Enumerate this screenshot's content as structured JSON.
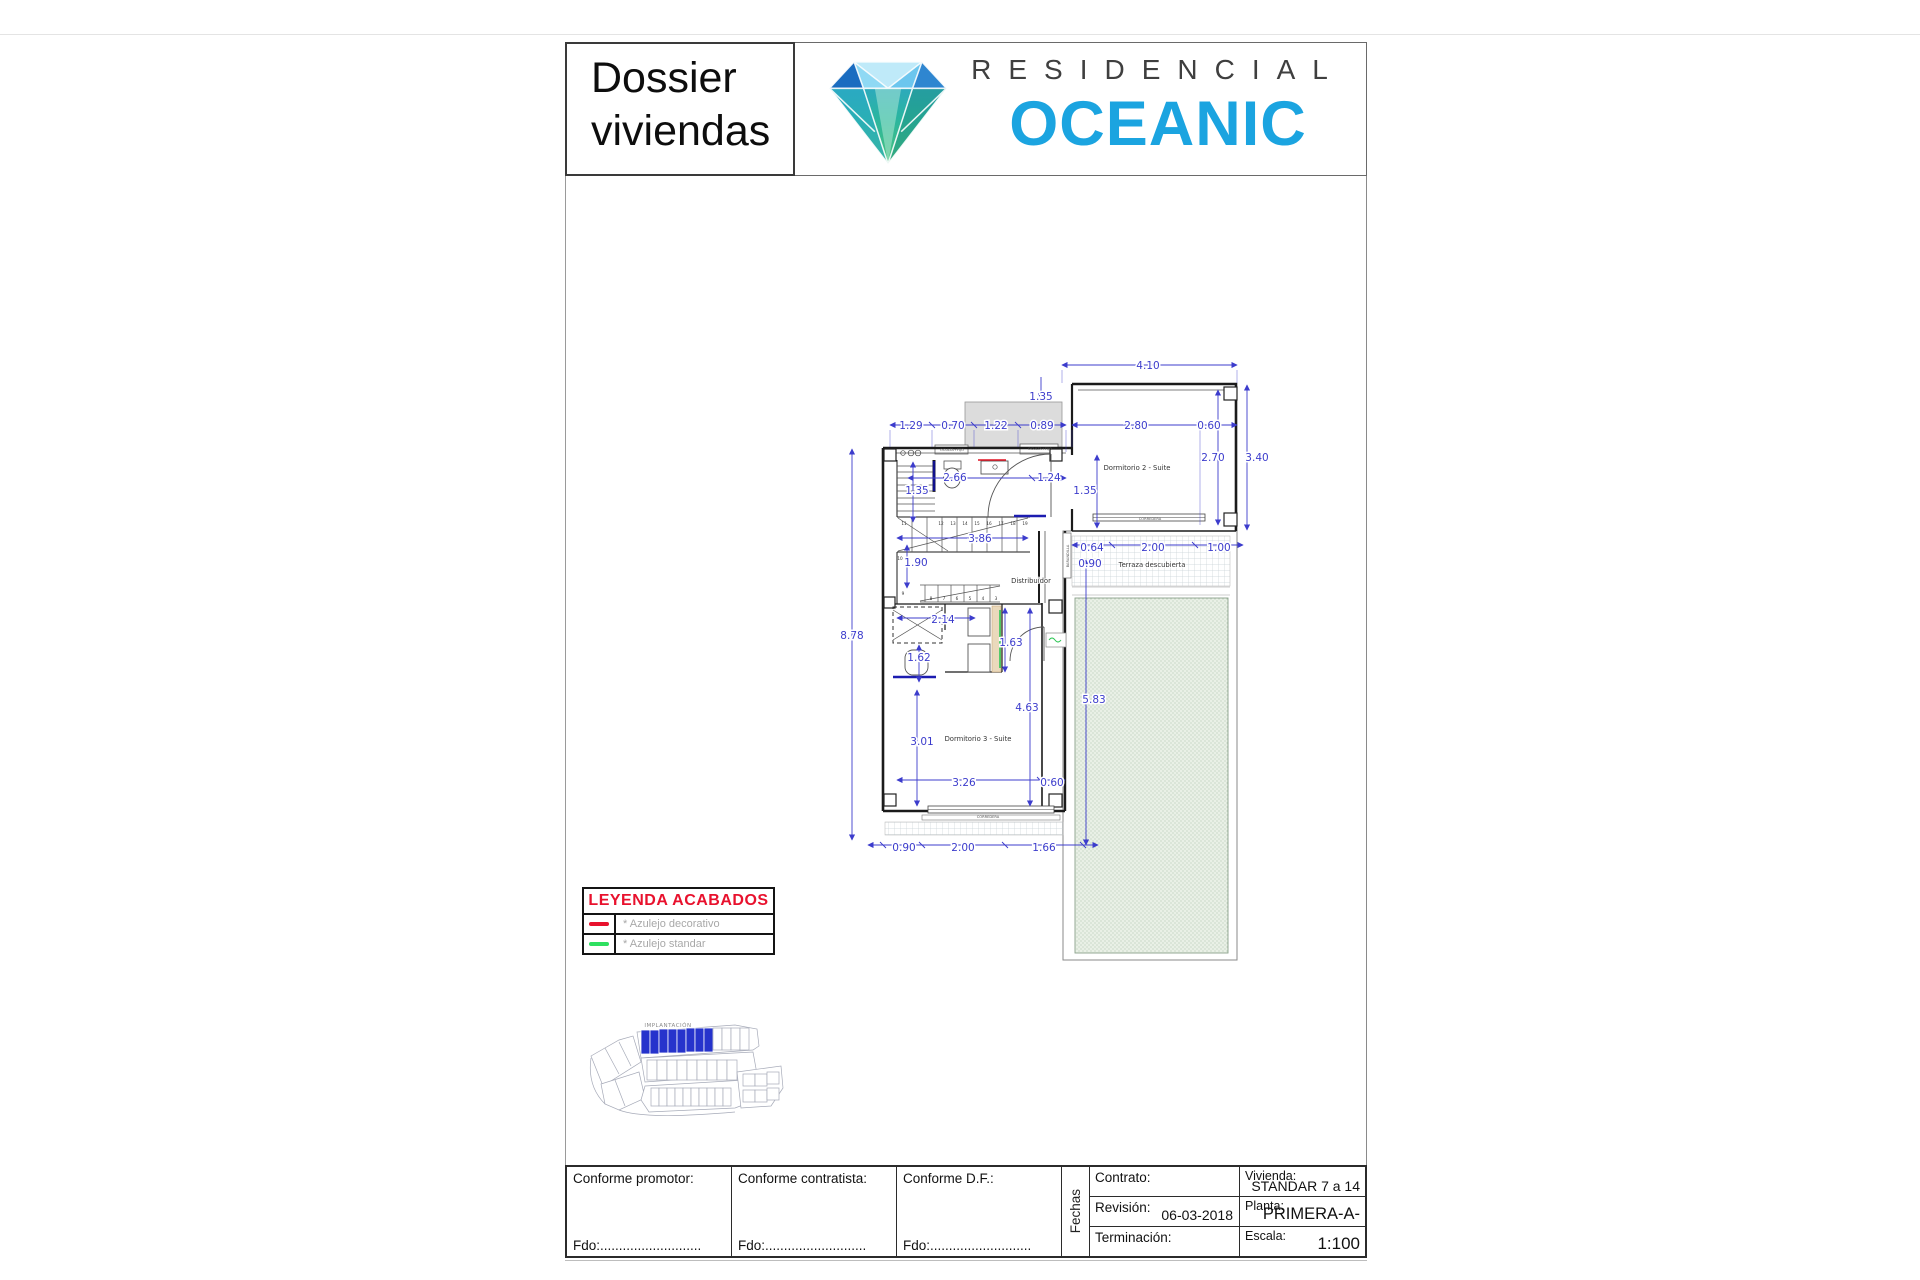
{
  "header": {
    "doc_title_line1": "Dossier",
    "doc_title_line2": "viviendas",
    "brand_word": "RESIDENCIAL",
    "brand_name": "OCEANIC",
    "brand_color": "#1ba4e0"
  },
  "legend": {
    "title": "LEYENDA ACABADOS",
    "items": [
      {
        "label": "* Azulejo decorativo",
        "color": "#e8112d"
      },
      {
        "label": "* Azulejo standar",
        "color": "#2ee060"
      }
    ]
  },
  "site_plan": {
    "label": "IMPLANTACIÓN",
    "highlight_color": "#2633cc"
  },
  "plan": {
    "rooms": [
      {
        "t": "Dormitorio 2 - Suite",
        "x": 1137,
        "y": 470
      },
      {
        "t": "Terraza descubierta",
        "x": 1152,
        "y": 567
      },
      {
        "t": "Distribuidor",
        "x": 1031,
        "y": 583
      },
      {
        "t": "Dormitorio 3 - Suite",
        "x": 978,
        "y": 741
      }
    ],
    "dimensions": [
      {
        "t": "4.10",
        "x": 1148,
        "y": 369
      },
      {
        "t": "1.35",
        "x": 1041,
        "y": 400
      },
      {
        "t": "1.29",
        "x": 911,
        "y": 429
      },
      {
        "t": "0.70",
        "x": 953,
        "y": 429
      },
      {
        "t": "1.22",
        "x": 996,
        "y": 429
      },
      {
        "t": "0.89",
        "x": 1042,
        "y": 429
      },
      {
        "t": "2.80",
        "x": 1136,
        "y": 429
      },
      {
        "t": "0.60",
        "x": 1209,
        "y": 429
      },
      {
        "t": "2.66",
        "x": 955,
        "y": 481
      },
      {
        "t": "1.24",
        "x": 1049,
        "y": 481
      },
      {
        "t": "1.35",
        "x": 917,
        "y": 494
      },
      {
        "t": "1.35",
        "x": 1085,
        "y": 494
      },
      {
        "t": "2.70",
        "x": 1213,
        "y": 461
      },
      {
        "t": "3.40",
        "x": 1257,
        "y": 461
      },
      {
        "t": "3.86",
        "x": 980,
        "y": 542
      },
      {
        "t": "1.90",
        "x": 916,
        "y": 566
      },
      {
        "t": "0.64",
        "x": 1092,
        "y": 551
      },
      {
        "t": "0.90",
        "x": 1090,
        "y": 567
      },
      {
        "t": "2.00",
        "x": 1153,
        "y": 551
      },
      {
        "t": "1.00",
        "x": 1219,
        "y": 551
      },
      {
        "t": "2.14",
        "x": 943,
        "y": 623
      },
      {
        "t": "1.63",
        "x": 1011,
        "y": 646
      },
      {
        "t": "1.62",
        "x": 919,
        "y": 661
      },
      {
        "t": "4.63",
        "x": 1027,
        "y": 711
      },
      {
        "t": "5.83",
        "x": 1094,
        "y": 703
      },
      {
        "t": "3.01",
        "x": 922,
        "y": 745
      },
      {
        "t": "3.26",
        "x": 964,
        "y": 786
      },
      {
        "t": "0.60",
        "x": 1052,
        "y": 786
      },
      {
        "t": "0.90",
        "x": 904,
        "y": 851
      },
      {
        "t": "2.00",
        "x": 963,
        "y": 851
      },
      {
        "t": "1.66",
        "x": 1044,
        "y": 851
      },
      {
        "t": "8.78",
        "x": 852,
        "y": 639
      }
    ],
    "tiny_labels": [
      {
        "t": "CORREDERA",
        "x": 1150,
        "y": 520
      },
      {
        "t": "CORREDERA",
        "x": 988,
        "y": 818
      },
      {
        "t": "OCULTA+FIJO",
        "x": 952,
        "y": 451
      },
      {
        "t": "OCULTA+FIJO",
        "x": 1040,
        "y": 450
      },
      {
        "t": "BARANDILLA",
        "x": 1069,
        "y": 556,
        "rot": -90
      }
    ],
    "stair_numbers": [
      {
        "t": "11",
        "x": 904,
        "y": 525
      },
      {
        "t": "12",
        "x": 941,
        "y": 525
      },
      {
        "t": "13",
        "x": 953,
        "y": 525
      },
      {
        "t": "14",
        "x": 965,
        "y": 525
      },
      {
        "t": "15",
        "x": 977,
        "y": 525
      },
      {
        "t": "16",
        "x": 989,
        "y": 525
      },
      {
        "t": "17",
        "x": 1001,
        "y": 525
      },
      {
        "t": "18",
        "x": 1013,
        "y": 525
      },
      {
        "t": "19",
        "x": 1025,
        "y": 525
      },
      {
        "t": "10",
        "x": 900,
        "y": 560
      },
      {
        "t": "9",
        "x": 903,
        "y": 595
      },
      {
        "t": "8",
        "x": 931,
        "y": 600
      },
      {
        "t": "7",
        "x": 944,
        "y": 600
      },
      {
        "t": "6",
        "x": 957,
        "y": 600
      },
      {
        "t": "5",
        "x": 970,
        "y": 600
      },
      {
        "t": "4",
        "x": 983,
        "y": 600
      },
      {
        "t": "3",
        "x": 996,
        "y": 600
      }
    ]
  },
  "title_block": {
    "signatures": [
      {
        "label": "Conforme promotor:",
        "fdo": "Fdo:..........................."
      },
      {
        "label": "Conforme contratista:",
        "fdo": "Fdo:..........................."
      },
      {
        "label": "Conforme D.F.:",
        "fdo": "Fdo:..........................."
      }
    ],
    "fechas": "Fechas",
    "left_rows": [
      {
        "label": "Contrato:",
        "value": ""
      },
      {
        "label": "Revisión:",
        "value": "06-03-2018"
      },
      {
        "label": "Terminación:",
        "value": ""
      }
    ],
    "right_rows": [
      {
        "label": "Vivienda:",
        "value": "STANDAR 7 a 14"
      },
      {
        "label": "Planta:",
        "value": "PRIMERA-A-"
      },
      {
        "label": "Escala:",
        "value": "1:100"
      }
    ]
  }
}
